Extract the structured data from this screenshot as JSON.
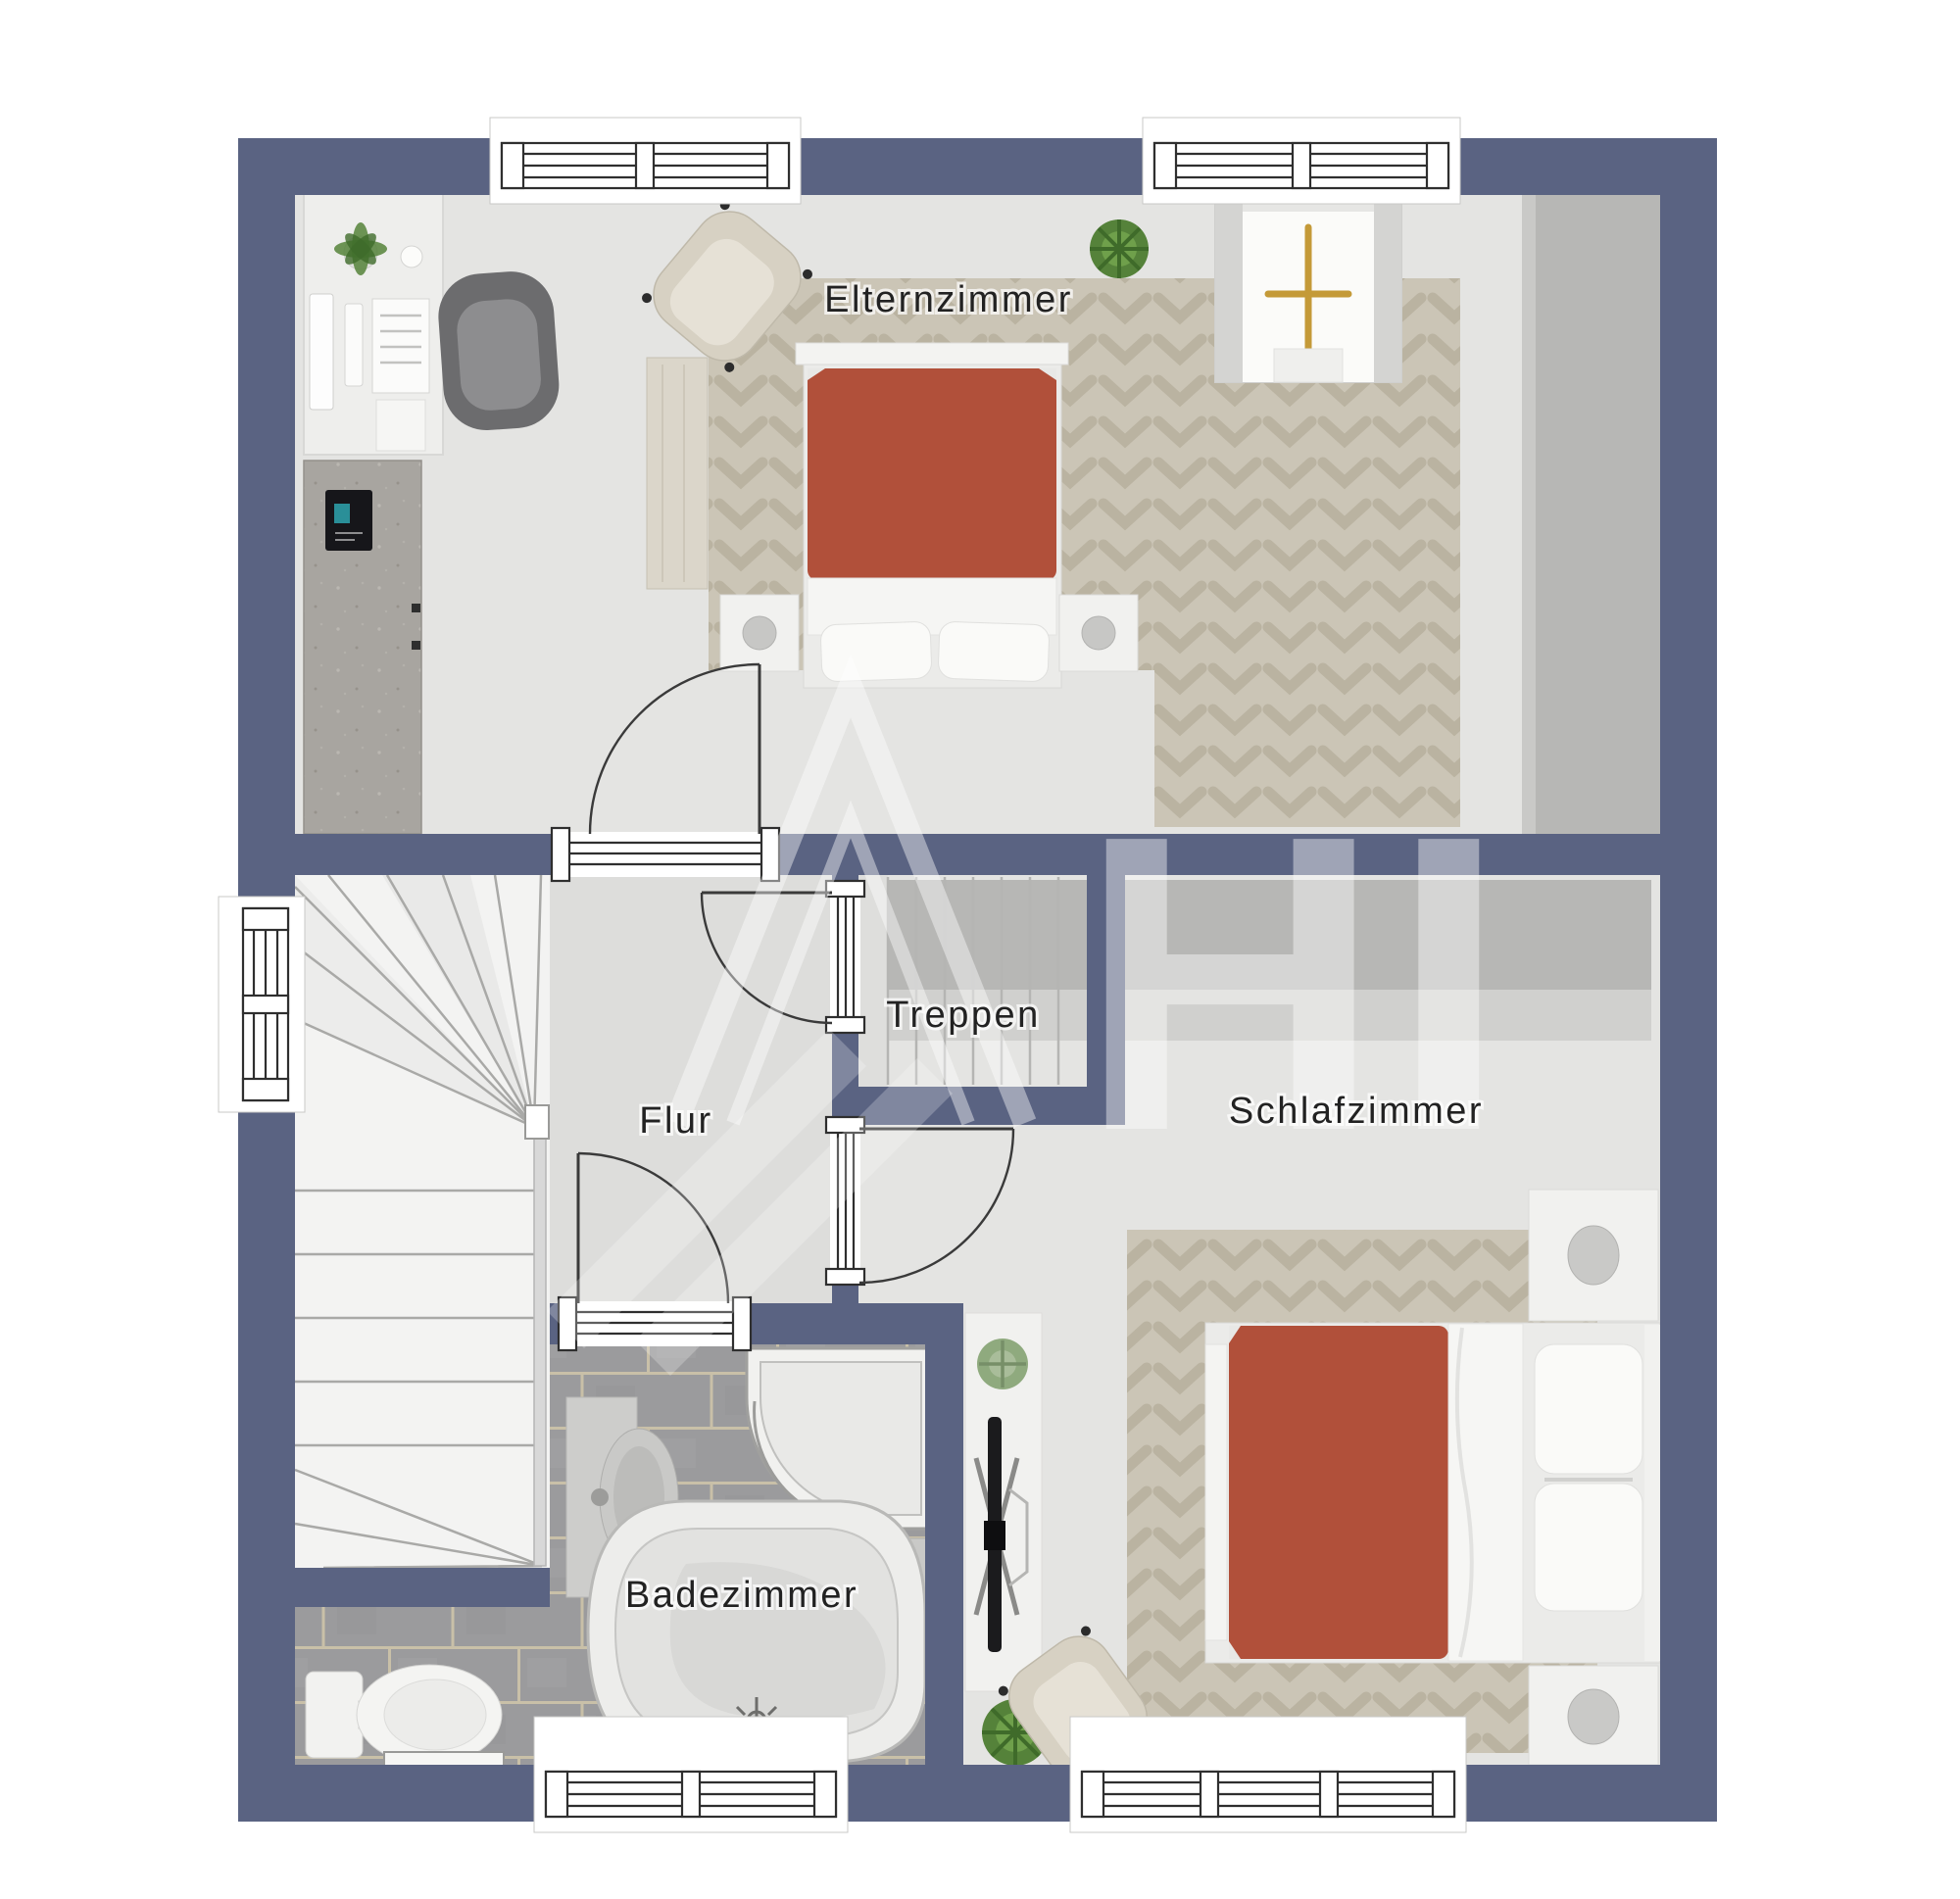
{
  "plan": {
    "rooms": {
      "elternzimmer": {
        "label": "Elternzimmer"
      },
      "treppen": {
        "label": "Treppen"
      },
      "flur": {
        "label": "Flur"
      },
      "schlafzimmer": {
        "label": "Schlafzimmer"
      },
      "badezimmer": {
        "label": "Badezimmer"
      }
    },
    "watermark": {
      "letters": "HI"
    },
    "colors": {
      "wall": "#5a6382",
      "floor": "#e4e4e2",
      "flurFloor": "#dddddb",
      "stairFloor": "#f3f3f2",
      "stairwellFloor": "#eaeae8",
      "tile": "#9b9b9d",
      "grout": "#c9c0a8",
      "rug": "#cbc5b6",
      "rugPattern": "#bab3a1",
      "duvet": "#b1503a",
      "duvetLight": "#c56a4e",
      "white": "#f1f1ef",
      "cream": "#d7d1c3",
      "creamLight": "#e6e1d6",
      "concrete": "#a8a5a0",
      "wardrobe": "#b7b7b5",
      "wardrobeLight": "#d0d0ce",
      "wood": "#dbd6ca",
      "plant": "#55823a",
      "plantDark": "#3f6b2a",
      "gold": "#c49a38",
      "tv": "#1b1b1d",
      "line": "#3a3a3a",
      "frame": "#2f2f2f",
      "label": "#222222",
      "watermark": "rgba(255,255,255,0.42)"
    }
  }
}
